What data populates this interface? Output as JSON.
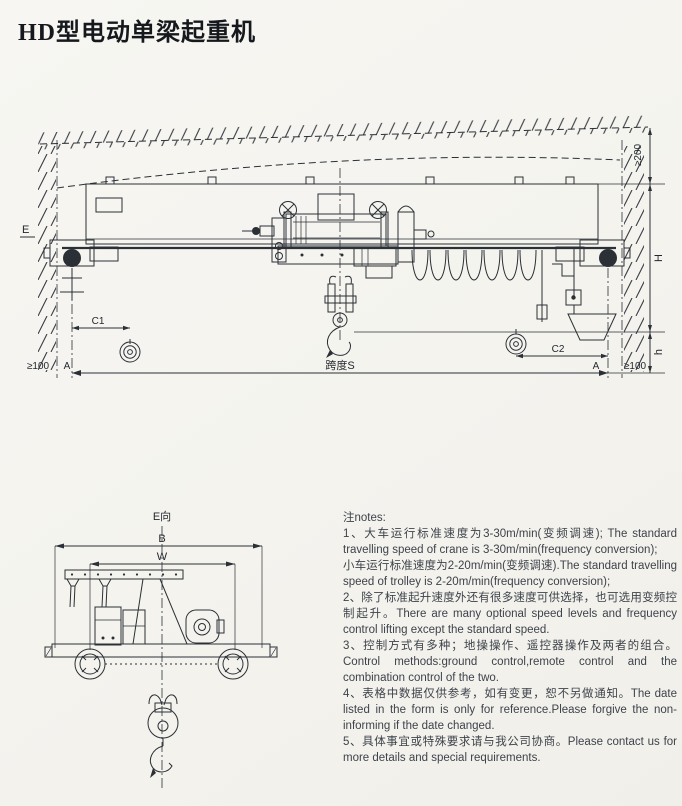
{
  "page": {
    "title": "HD型电动单梁起重机",
    "paper_color": "#f6f5f1",
    "ink_color": "#2b3036",
    "notes_text_color": "#3d434b"
  },
  "main_view": {
    "labels": {
      "view_e": "E",
      "top_clearance": "≥200",
      "lift_height": "H",
      "hook_height": "h",
      "side_clearance_left": "≥100",
      "side_clearance_right": "≥100",
      "rail_center_left": "A",
      "rail_center_right": "A",
      "hook_approach_left": "C1",
      "hook_approach_right": "C2",
      "span": "跨度S"
    }
  },
  "side_view": {
    "labels": {
      "view_caption": "E向",
      "width": "B",
      "wheelbase": "W"
    }
  },
  "notes": {
    "heading": "注notes:",
    "items": [
      "1、大车运行标准速度为3-30m/min(变频调速); The standard travelling speed of crane is 3-30m/min(frequency conversion);",
      "小车运行标准速度为2-20m/min(变频调速).The standard travelling speed of trolley is 2-20m/min(frequency conversion);",
      "2、除了标准起升速度外还有很多速度可供选择，也可选用变频控制起升。There are many optional speed levels and frequency control lifting except the standard speed.",
      "3、控制方式有多种；地操操作、遥控器操作及两者的组合。Control methods:ground control,remote control and the combination control of the two.",
      "4、表格中数据仅供参考，如有变更，恕不另做通知。The date listed in the form is only for reference.Please forgive the non-informing if the date changed.",
      "5、具体事宜或特殊要求请与我公司协商。Please contact us for more details and special requirements."
    ]
  }
}
